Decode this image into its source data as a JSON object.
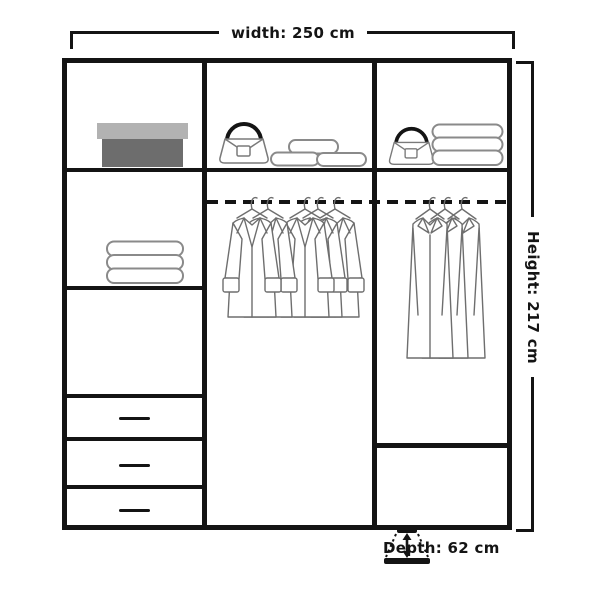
{
  "figure": {
    "title": "wardrobe interior dimensions diagram",
    "labels": {
      "width": "width: 250 cm",
      "height": "Height: 217 cm",
      "depth": "Depth: 62 cm"
    }
  },
  "colors": {
    "background": "#ffffff",
    "frame_lines": "#141414",
    "item_outline_gray": "#6e6e6e",
    "box_lid_gray": "#b2b2b2",
    "box_body_gray": "#6d6d6d"
  },
  "icons": {
    "depth": "depth-arrow-icon",
    "rail": "hanging-rail-dashed",
    "coat": "coat-on-hanger-icon",
    "handbag": "handbag-icon",
    "towels": "folded-towel-stack-icon",
    "cushions": "cushion-stack-icon",
    "box": "storage-box-icon"
  },
  "wardrobe": {
    "columns": [
      {
        "id": "left",
        "compartments": [
          {
            "content": "storage-box"
          },
          {
            "content": "folded-towel-stack"
          },
          {
            "content": "empty-shelf"
          },
          {
            "content": "drawer"
          },
          {
            "content": "drawer"
          },
          {
            "content": "drawer"
          }
        ]
      },
      {
        "id": "middle",
        "compartments": [
          {
            "content": "handbag-and-cushions"
          },
          {
            "content": "hanging-rail-with-coats",
            "coat_count": 5
          }
        ]
      },
      {
        "id": "right",
        "compartments": [
          {
            "content": "handbag-and-folded-towels"
          },
          {
            "content": "hanging-rail-with-long-coats",
            "coat_count": 3
          },
          {
            "content": "empty-bottom-compartment"
          }
        ]
      }
    ]
  }
}
